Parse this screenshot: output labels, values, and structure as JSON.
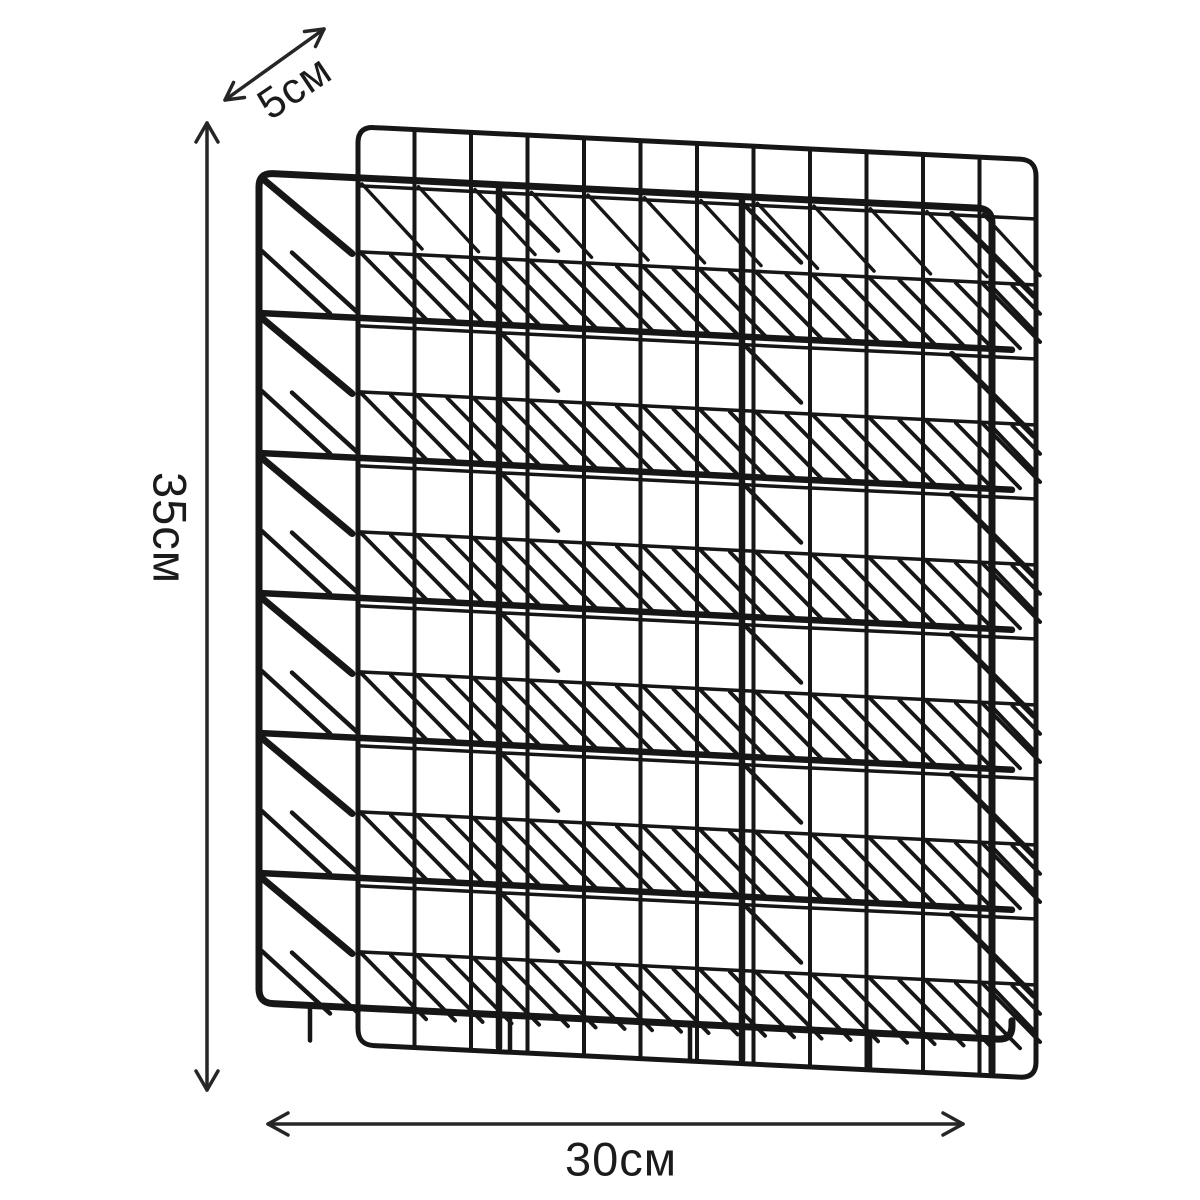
{
  "page": {
    "background": "#ffffff"
  },
  "product": {
    "type": "wall-mounted wire file organizer rack",
    "tiers": 6,
    "back_columns": 12,
    "wire_color": "#161616"
  },
  "dimensions": {
    "arrow_color": "#262626",
    "depth": {
      "label": "5см"
    },
    "height": {
      "label": "35см"
    },
    "width": {
      "label": "30см"
    }
  }
}
